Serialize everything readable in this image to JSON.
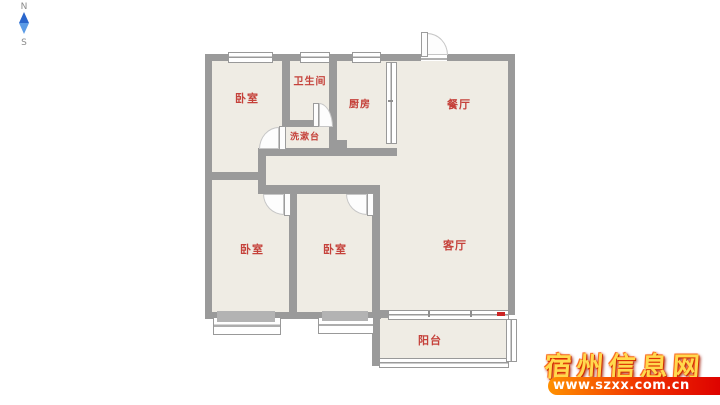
{
  "compass": {
    "north_label": "N",
    "south_label": "S",
    "needle_color_top": "#2a66cc",
    "needle_color_bottom": "#5c9ce6"
  },
  "floorplan": {
    "rooms": [
      {
        "id": "bedroom-top-left",
        "label": "卧室"
      },
      {
        "id": "bathroom",
        "label": "卫生间"
      },
      {
        "id": "washstand",
        "label": "洗漱台"
      },
      {
        "id": "kitchen",
        "label": "厨房"
      },
      {
        "id": "dining-room",
        "label": "餐厅"
      },
      {
        "id": "bedroom-bottom-left",
        "label": "卧室"
      },
      {
        "id": "bedroom-bottom-middle",
        "label": "卧室"
      },
      {
        "id": "living-room",
        "label": "客厅"
      },
      {
        "id": "balcony",
        "label": "阳台"
      }
    ],
    "colors": {
      "wall": "#9a9a9a",
      "floor": "#efece4",
      "room_label": "#c5413a"
    }
  },
  "watermark": {
    "site_name": "宿州信息网",
    "site_url": "www.szxx.com.cn",
    "title_color": "#ffd94e",
    "title_outline_color": "#e93600",
    "bar_gradient": [
      "#ff9000",
      "#dd0000"
    ],
    "url_text_color": "#ffffff"
  }
}
